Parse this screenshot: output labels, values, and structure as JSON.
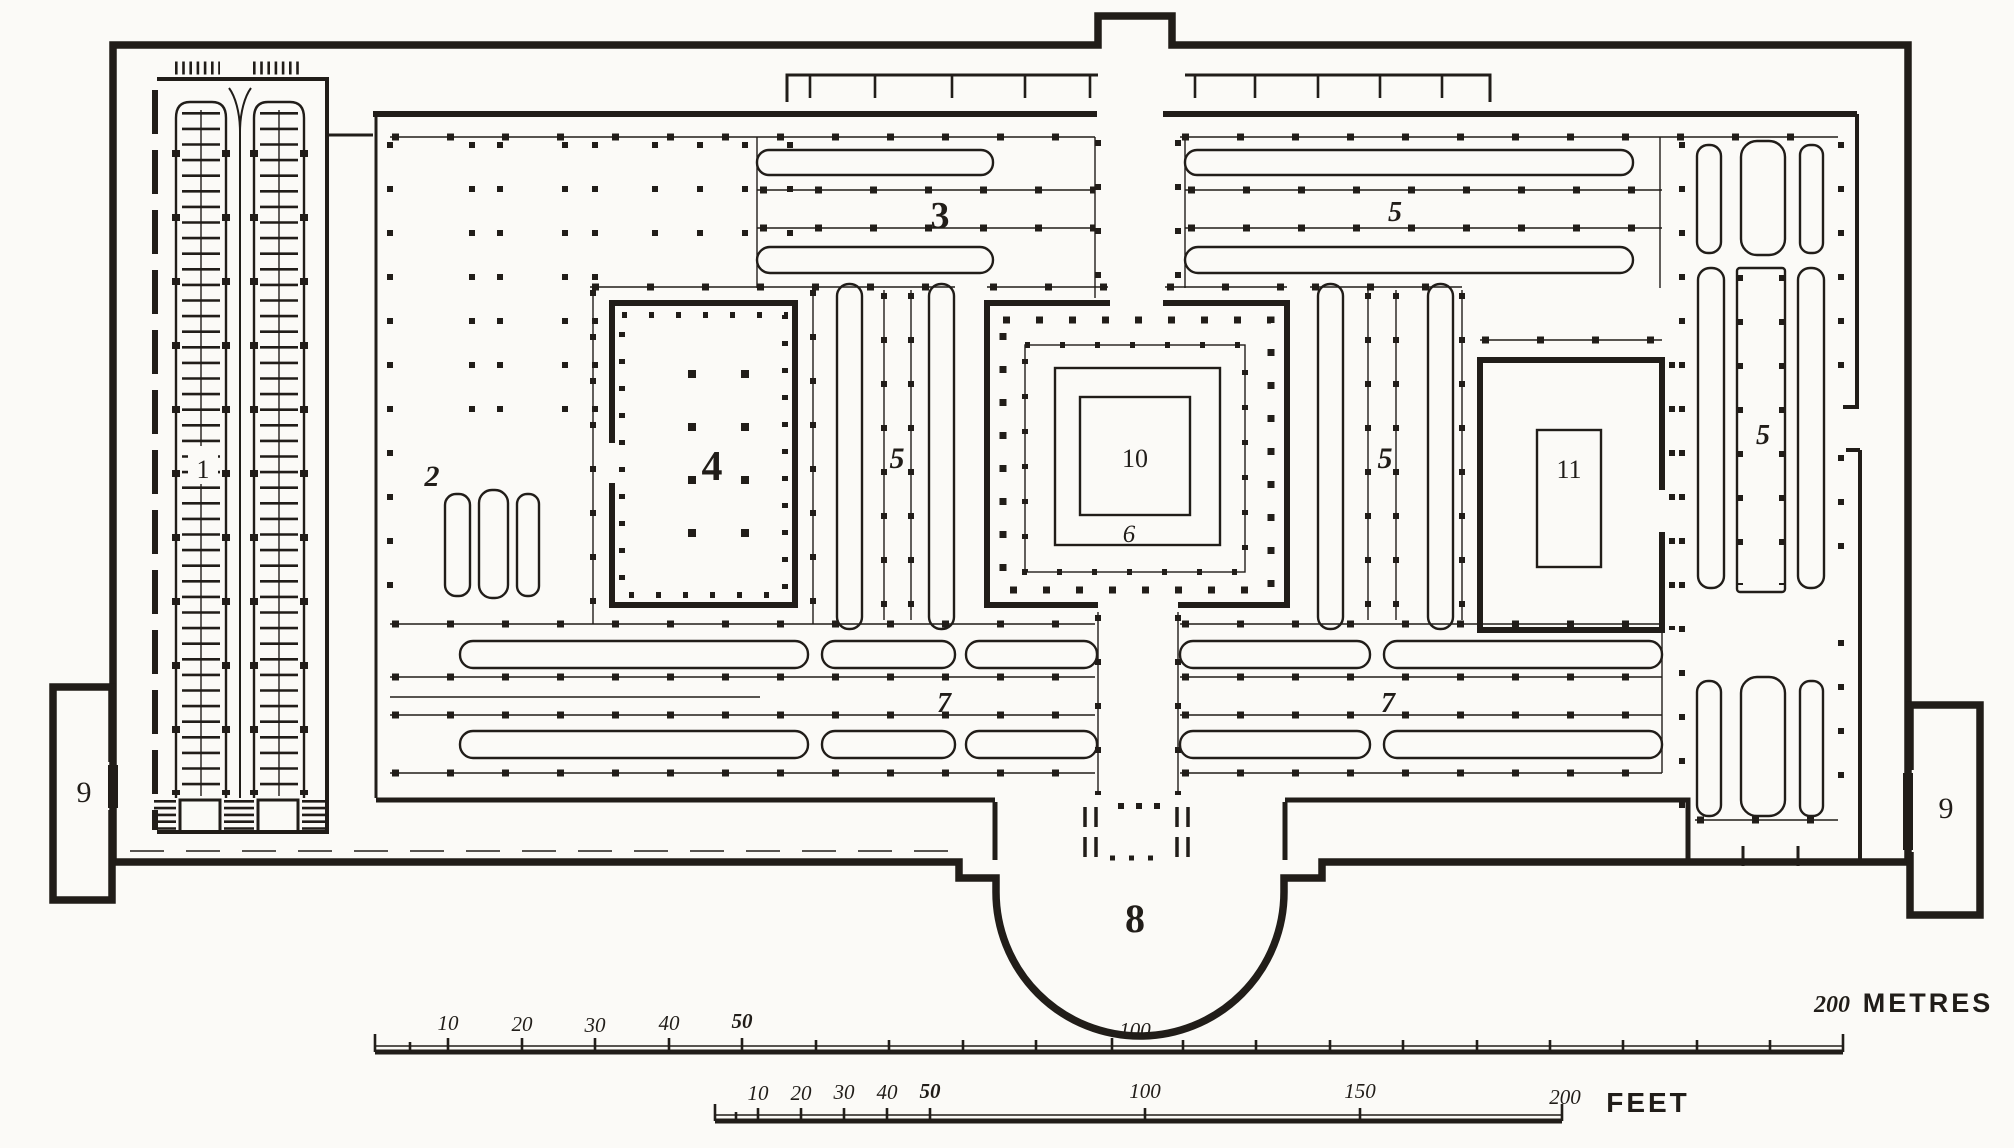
{
  "palette": {
    "paper": "#fbfaf7",
    "ink": "#211d19"
  },
  "plan": {
    "labels": {
      "n1": "1",
      "n2": "2",
      "n3": "3",
      "n4": "4",
      "n5": "5",
      "n6": "6",
      "n7": "7",
      "n8": "8",
      "n9": "9",
      "n10": "10",
      "n11": "11"
    }
  },
  "scales": {
    "metres": {
      "t10": "10",
      "t20": "20",
      "t30": "30",
      "t40": "40",
      "t50": "50",
      "t100": "100",
      "t200": "200",
      "unit": "METRES"
    },
    "feet": {
      "t10": "10",
      "t20": "20",
      "t30": "30",
      "t40": "40",
      "t50": "50",
      "t100": "100",
      "t150": "150",
      "t200": "200",
      "unit": "FEET"
    }
  }
}
